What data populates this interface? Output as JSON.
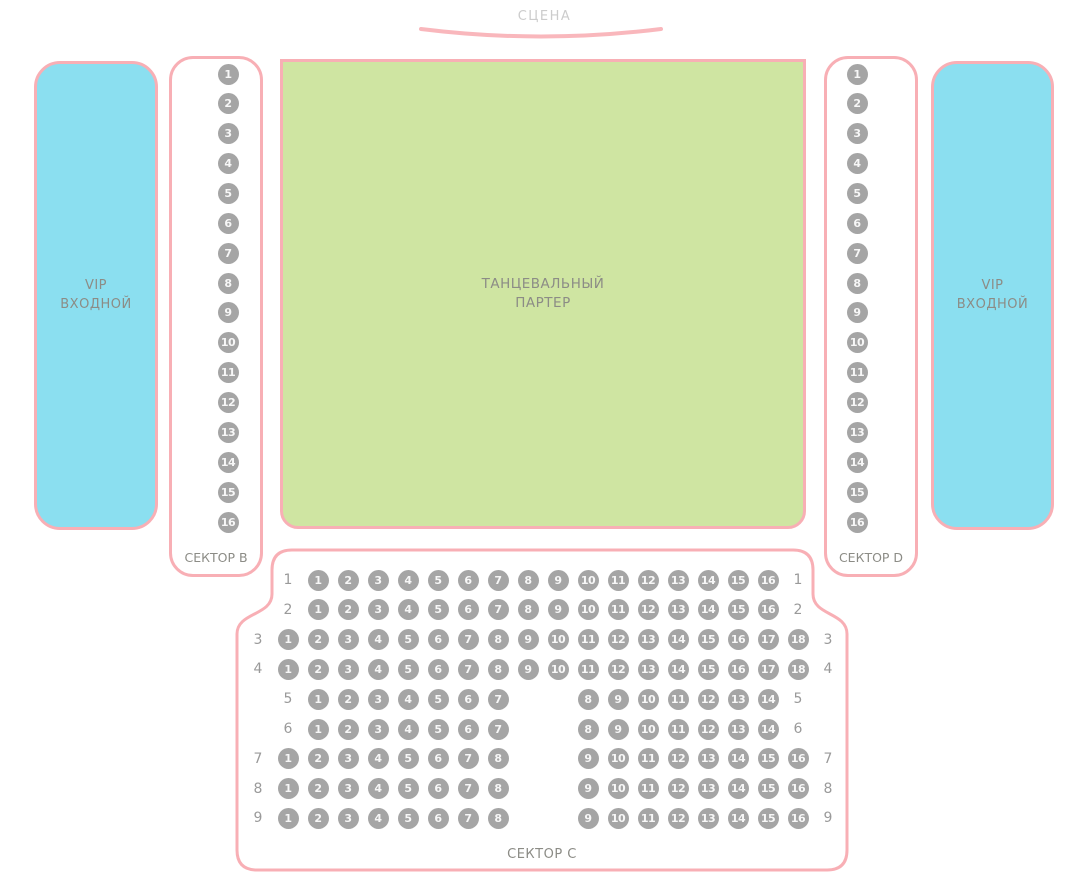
{
  "stage": {
    "label": "СЦЕНА"
  },
  "vip_left": {
    "lines": [
      "VIP",
      "ВХОДНОЙ"
    ]
  },
  "vip_right": {
    "lines": [
      "VIP",
      "ВХОДНОЙ"
    ]
  },
  "dance_floor": {
    "lines": [
      "ТАНЦЕВАЛЬНЫЙ",
      "ПАРТЕР"
    ]
  },
  "sector_b": {
    "label": "СЕКТОР B",
    "seats": [
      1,
      2,
      3,
      4,
      5,
      6,
      7,
      8,
      9,
      10,
      11,
      12,
      13,
      14,
      15,
      16
    ]
  },
  "sector_d": {
    "label": "СЕКТОР D",
    "seats": [
      1,
      2,
      3,
      4,
      5,
      6,
      7,
      8,
      9,
      10,
      11,
      12,
      13,
      14,
      15,
      16
    ]
  },
  "sector_c": {
    "label": "СЕКТОР C",
    "rows": [
      {
        "label": "1",
        "groups": [
          {
            "start_col": 1,
            "seats": [
              1,
              2,
              3,
              4,
              5,
              6,
              7,
              8,
              9,
              10,
              11,
              12,
              13,
              14,
              15,
              16
            ]
          }
        ]
      },
      {
        "label": "2",
        "groups": [
          {
            "start_col": 1,
            "seats": [
              1,
              2,
              3,
              4,
              5,
              6,
              7,
              8,
              9,
              10,
              11,
              12,
              13,
              14,
              15,
              16
            ]
          }
        ]
      },
      {
        "label": "3",
        "groups": [
          {
            "start_col": 0,
            "seats": [
              1,
              2,
              3,
              4,
              5,
              6,
              7,
              8,
              9,
              10,
              11,
              12,
              13,
              14,
              15,
              16,
              17,
              18
            ]
          }
        ]
      },
      {
        "label": "4",
        "groups": [
          {
            "start_col": 0,
            "seats": [
              1,
              2,
              3,
              4,
              5,
              6,
              7,
              8,
              9,
              10,
              11,
              12,
              13,
              14,
              15,
              16,
              17,
              18
            ]
          }
        ]
      },
      {
        "label": "5",
        "groups": [
          {
            "start_col": 1,
            "seats": [
              1,
              2,
              3,
              4,
              5,
              6,
              7
            ]
          },
          {
            "start_col": 10,
            "seats": [
              8,
              9,
              10,
              11,
              12,
              13,
              14
            ]
          }
        ]
      },
      {
        "label": "6",
        "groups": [
          {
            "start_col": 1,
            "seats": [
              1,
              2,
              3,
              4,
              5,
              6,
              7
            ]
          },
          {
            "start_col": 10,
            "seats": [
              8,
              9,
              10,
              11,
              12,
              13,
              14
            ]
          }
        ]
      },
      {
        "label": "7",
        "groups": [
          {
            "start_col": 0,
            "seats": [
              1,
              2,
              3,
              4,
              5,
              6,
              7,
              8
            ]
          },
          {
            "start_col": 10,
            "seats": [
              9,
              10,
              11,
              12,
              13,
              14,
              15,
              16
            ]
          }
        ]
      },
      {
        "label": "8",
        "groups": [
          {
            "start_col": 0,
            "seats": [
              1,
              2,
              3,
              4,
              5,
              6,
              7,
              8
            ]
          },
          {
            "start_col": 10,
            "seats": [
              9,
              10,
              11,
              12,
              13,
              14,
              15,
              16
            ]
          }
        ]
      },
      {
        "label": "9",
        "groups": [
          {
            "start_col": 0,
            "seats": [
              1,
              2,
              3,
              4,
              5,
              6,
              7,
              8
            ]
          },
          {
            "start_col": 10,
            "seats": [
              9,
              10,
              11,
              12,
              13,
              14,
              15,
              16
            ]
          }
        ]
      }
    ]
  },
  "colors": {
    "pink_border": "#F8AFB5",
    "cyan_fill": "#8BDFF0",
    "green_fill": "#CFE5A2",
    "seat_fill": "#A5A5A5",
    "seat_number": "#F7F7F7",
    "label_gray": "#8C8C86",
    "stage_gray": "#CCCCCC",
    "row_label_gray": "#9A9A9A"
  }
}
